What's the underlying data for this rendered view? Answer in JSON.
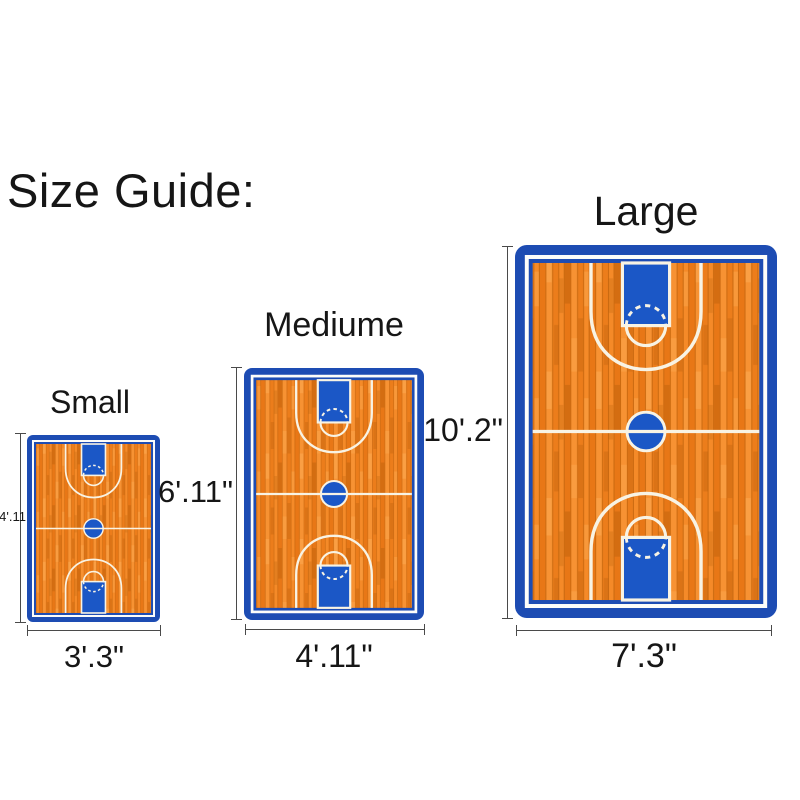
{
  "title": "Size Guide:",
  "products": [
    {
      "id": "small",
      "name": "Small",
      "width": "3'.3\"",
      "height": "4'.11"
    },
    {
      "id": "medium",
      "name": "Mediume",
      "width": "4'.11\"",
      "height": "6'.11\""
    },
    {
      "id": "large",
      "name": "Large",
      "width": "7'.3\"",
      "height": "10'.2\""
    }
  ],
  "colors": {
    "rug-border-blue": "#1d4cb3",
    "rug-key-blue": "#1b57c6",
    "court-orange": "#ef8424",
    "court-orange-light": "#f79233",
    "court-orange-dark": "#e87716",
    "plank-seam": "#cb6a10",
    "court-line-cream": "#f8f3e4",
    "dimension-line": "#4a4a4a",
    "text": "#161616"
  }
}
